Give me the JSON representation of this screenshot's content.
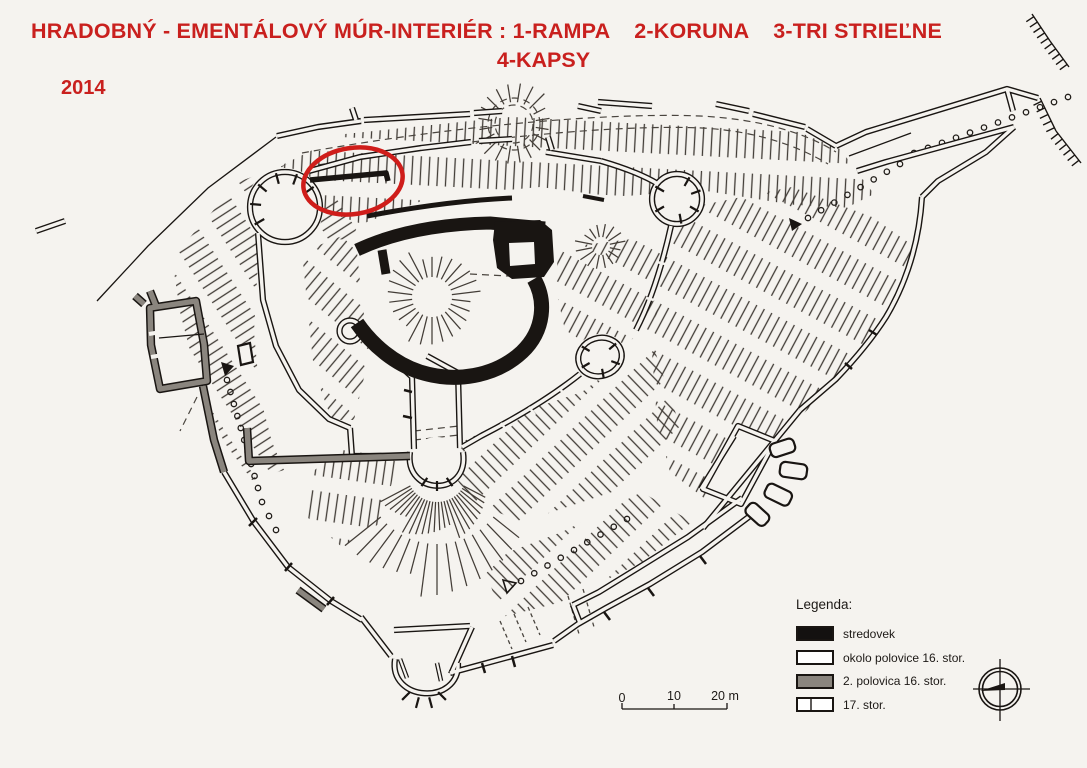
{
  "title": {
    "line1": "HRADOBNÝ - EMENTÁLOVÝ MÚR-INTERIÉR : 1-RAMPA    2-KORUNA    3-TRI STRIEĽNE",
    "line2": "4-KAPSY",
    "year": "2014",
    "color": "#c9201e"
  },
  "annotation": {
    "type": "ellipse-highlight",
    "color": "#cf1d1a"
  },
  "colors": {
    "background": "#f5f3ef",
    "ink": "#191512",
    "gray_wall": "#8a857e",
    "medieval_black": "#191512"
  },
  "legend": {
    "heading": "Legenda:",
    "items": [
      {
        "label": "stredovek",
        "swatch": "black",
        "fill": "#131110"
      },
      {
        "label": "okolo polovice 16. stor.",
        "swatch": "white",
        "fill": "#ffffff"
      },
      {
        "label": "2. polovica 16. stor.",
        "swatch": "gray",
        "fill": "#8a857e"
      },
      {
        "label": "17. stor.",
        "swatch": "white-divided",
        "fill": "#ffffff"
      }
    ]
  },
  "scale_bar": {
    "tick_labels": [
      "0",
      "10",
      "20 m"
    ]
  },
  "compass": {
    "name": "compass-rose"
  }
}
